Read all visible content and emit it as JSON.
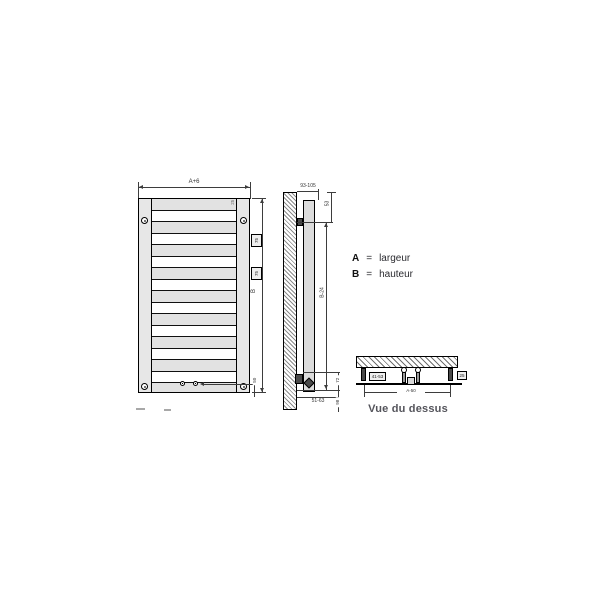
{
  "legend": {
    "rows": [
      {
        "key": "A",
        "eq": "=",
        "value": "largeur"
      },
      {
        "key": "B",
        "eq": "=",
        "value": "hauteur"
      }
    ]
  },
  "front_view": {
    "width_dim": "A+6",
    "height_dim": "B",
    "spacing_dim_1": "75",
    "spacing_dim_2": "75",
    "top_right_dim": "25",
    "bottom_dim": "50"
  },
  "side_view": {
    "wall_distance_dim": "93-105",
    "top_offset_dim": "53",
    "height_dim": "B-24",
    "bottom_dim": "51-63",
    "depth_dim": "72",
    "pipe_dim": "98"
  },
  "top_view": {
    "caption": "Vue du dessus",
    "left_dim": "41-53",
    "right_dim": "25",
    "center_dim": "A-50"
  },
  "colors": {
    "object_line": "#000000",
    "dim_line": "#3d3d3d",
    "fill_light": "#e7e7e7",
    "fill_dark": "#4a4a4a",
    "caption": "#54545b"
  }
}
